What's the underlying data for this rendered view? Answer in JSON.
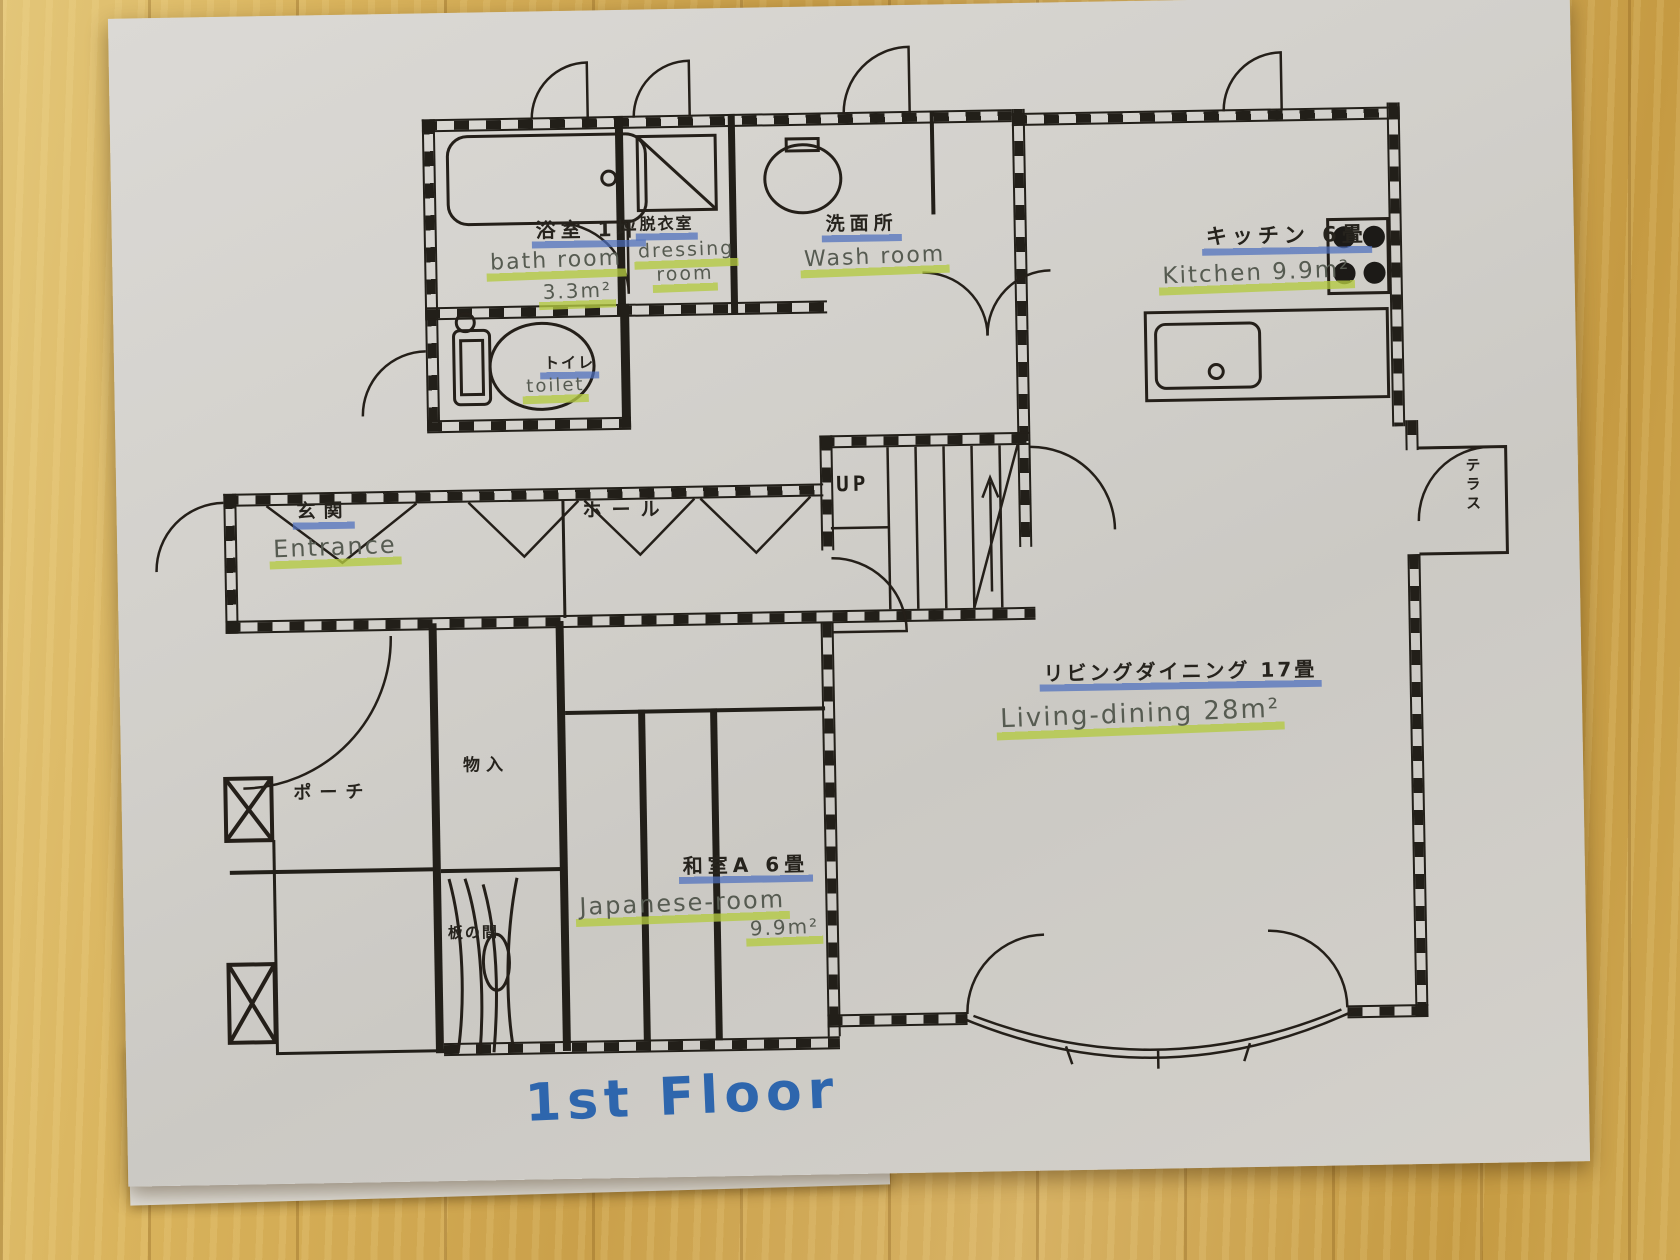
{
  "scene": {
    "floor_title": "1st Floor"
  },
  "rooms": {
    "bath": {
      "jp": "浴室 1坪",
      "en": "bath room",
      "area": "3.3m²"
    },
    "dressing": {
      "jp": "脱衣室",
      "en1": "dressing",
      "en2": "room"
    },
    "washroom": {
      "jp": "洗面所",
      "en": "Wash room"
    },
    "kitchen": {
      "jp": "キッチン 6畳",
      "en": "Kitchen 9.9m²"
    },
    "toilet": {
      "jp": "トイレ",
      "en": "toilet"
    },
    "hall": {
      "jp": "ホール"
    },
    "entrance": {
      "jp": "玄関",
      "en": "Entrance"
    },
    "porch": {
      "jp": "ポーチ"
    },
    "storage": {
      "jp": "物入"
    },
    "japanese_room": {
      "jp": "和室A 6畳",
      "en": "Japanese-room",
      "area": "9.9m²"
    },
    "living_dining": {
      "jp": "リビングダイニング 17畳",
      "en": "Living-dining 28m²"
    },
    "terrace": {
      "jp": "テラス"
    },
    "wood_floor": {
      "jp": "板の間"
    },
    "stairs": {
      "label": "UP"
    }
  },
  "colors": {
    "wood_table": "#d4a94f",
    "paper": "#d3d1cc",
    "ink": "#221f19",
    "pencil": "#565b51",
    "highlight_blue": "#4d6fbe",
    "highlight_green": "#b4ca41",
    "marker_blue": "#2e66ad"
  }
}
